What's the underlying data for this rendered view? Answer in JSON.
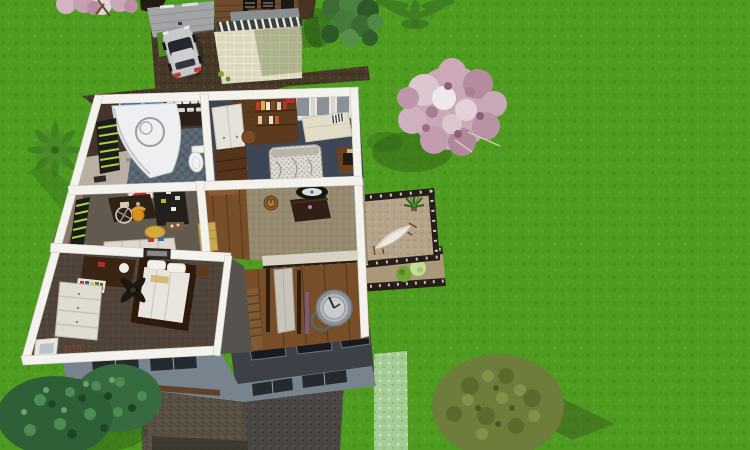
{
  "viewport": {
    "type": "3d-home-design-aerial-view",
    "wall_letters_text": "KIT"
  },
  "palette": {
    "grass": "#4F9C20",
    "grass_dot_dark": "#46911C",
    "grass_dot_light": "#58A62B",
    "pale_grass": "#A6CC95",
    "path_brown": "#473928",
    "gravel_brown": "#575043",
    "gravel_gray": "#4A4744",
    "wall_white": "#F4F2EC",
    "roof_dark": "#3C4148",
    "facade_blue_gray": "#77848E",
    "balcony_floor": "#B5A489",
    "railing_dark": "#261E16",
    "patio_tile": "#DBD8BE",
    "garage_door": "#A2A4A6",
    "deck_wood": "#6E4C2D",
    "car_silver": "#C6C8CA",
    "blossom_pink": "#C9A9B7",
    "conifer_green": "#2E6038",
    "olive_green": "#6F7D3C",
    "leafy_green": "#3C6E33",
    "bathroom_tile": "#5E6B76",
    "bedroom1_floor": "#3C4654",
    "office_floor": "#635A4F",
    "hall_carpet": "#958A70",
    "bedroom2_carpet": "#50443A",
    "entry_wood": "#784E28"
  },
  "scene": {
    "main_house_rooms": [
      {
        "name": "bathroom",
        "features": [
          "corner-bathtub",
          "toilet",
          "blue-mosaic-art",
          "towel-shelf",
          "checkered-tile-floor",
          "green-shutter-window"
        ]
      },
      {
        "name": "bedroom-1",
        "features": [
          "floral-double-bed",
          "white-wardrobe",
          "bookshelf",
          "cream-bench",
          "striped-pillows",
          "round-side-table",
          "desk",
          "windows"
        ]
      },
      {
        "name": "office",
        "features": [
          "dark-desk",
          "orange-chair",
          "pinboard",
          "red-wall-art",
          "bicycle-wheel",
          "yellow-round-rug",
          "white-cabinet",
          "green-shutter-window"
        ]
      },
      {
        "name": "hallway",
        "features": [
          "console-table",
          "oval-mirror",
          "wooden-wall-clock",
          "tan-dresser",
          "wood-floor-strip",
          "stair-railing"
        ]
      },
      {
        "name": "entry-stairwell",
        "features": [
          "staircase",
          "open-doors",
          "giant-clock"
        ]
      },
      {
        "name": "bedroom-2",
        "features": [
          "white-bed",
          "ceiling-fan",
          "white-dresser",
          "desk-with-lamp",
          "colored-books-shelf",
          "picture-frame",
          "wall-letters",
          "window"
        ]
      }
    ],
    "outdoor": [
      "balcony-with-hammock",
      "potted-plant",
      "lower-deck",
      "bushes"
    ],
    "neighbor_house": [
      "garage-door",
      "wooden-deck",
      "lounge-chairs",
      "gray-awning",
      "pergola",
      "tiled-patio"
    ],
    "vehicles": [
      "silver-car"
    ],
    "trees": [
      "blossom-tree-corner",
      "palm-top-edge",
      "leafy-tree",
      "large-blossom-tree",
      "palm-tree-left",
      "conifer-group",
      "olive-tree"
    ]
  }
}
